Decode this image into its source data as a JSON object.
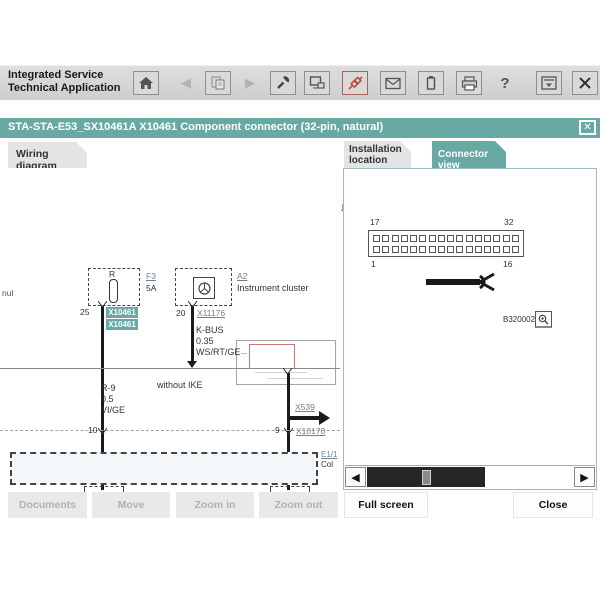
{
  "header": {
    "app_title_1": "Integrated Service",
    "app_title_2": "Technical Application",
    "vin_label": "VIN:",
    "car_label": "CAR:",
    "car_value": "X'/E53/OFF-ROAD VEHICLE/X5 3.0d/M57/AUTO/EUR LL/2006/1"
  },
  "toolbar": {
    "icons": [
      "home-icon",
      "back-icon",
      "vehicle-document-icon",
      "forward-icon",
      "workshop-icon",
      "monitor-icon",
      "connector-icon",
      "mail-icon",
      "battery-icon",
      "print-icon",
      "help-icon",
      "minimize-window-icon",
      "close-icon"
    ]
  },
  "dialog": {
    "title": "STA-STA-E53_SX10461A X10461 Component connector (32-pin, natural)",
    "close_glyph": "✕"
  },
  "tabs": {
    "wiring": "Wiring diagram",
    "installation_1": "Installation",
    "installation_2": "location",
    "connector": "Connector view",
    "active": "Connector view"
  },
  "wiring": {
    "edge_text": "nul",
    "fuse": {
      "label": "R",
      "ref": "F3",
      "rating": "5A",
      "pin": "25",
      "tag1": "X10461",
      "tag2": "X10461"
    },
    "cluster": {
      "ref": "A2",
      "name": "Instrument cluster",
      "pin": "20",
      "connector": "X11176",
      "wire_name": "K-BUS",
      "wire_size": "0.35",
      "wire_color": "WS/RT/GE"
    },
    "left_wire": {
      "name": "R-9",
      "size": "0.5",
      "color": "VI/GE"
    },
    "note": "without IKE",
    "branch_link": "X539",
    "pin_left": "10",
    "pin_right": "9",
    "connector_link": "X10170",
    "bottom_ref": "E1/1",
    "bottom_name": "Col"
  },
  "connector_view": {
    "pin_top_left": "17",
    "pin_top_right": "32",
    "pin_bottom_left": "1",
    "pin_bottom_right": "16",
    "pins_per_row": 16,
    "photo_ref": "B320002",
    "magnifier_icon": "magnifier-icon"
  },
  "buttons": {
    "documents": "Documents",
    "move": "Move",
    "zoom_in": "Zoom in",
    "zoom_out": "Zoom out",
    "full_screen": "Full screen",
    "close": "Close"
  },
  "colors": {
    "teal": "#68a9a4",
    "red_accent": "#c14b42",
    "link": "#6e8195"
  }
}
